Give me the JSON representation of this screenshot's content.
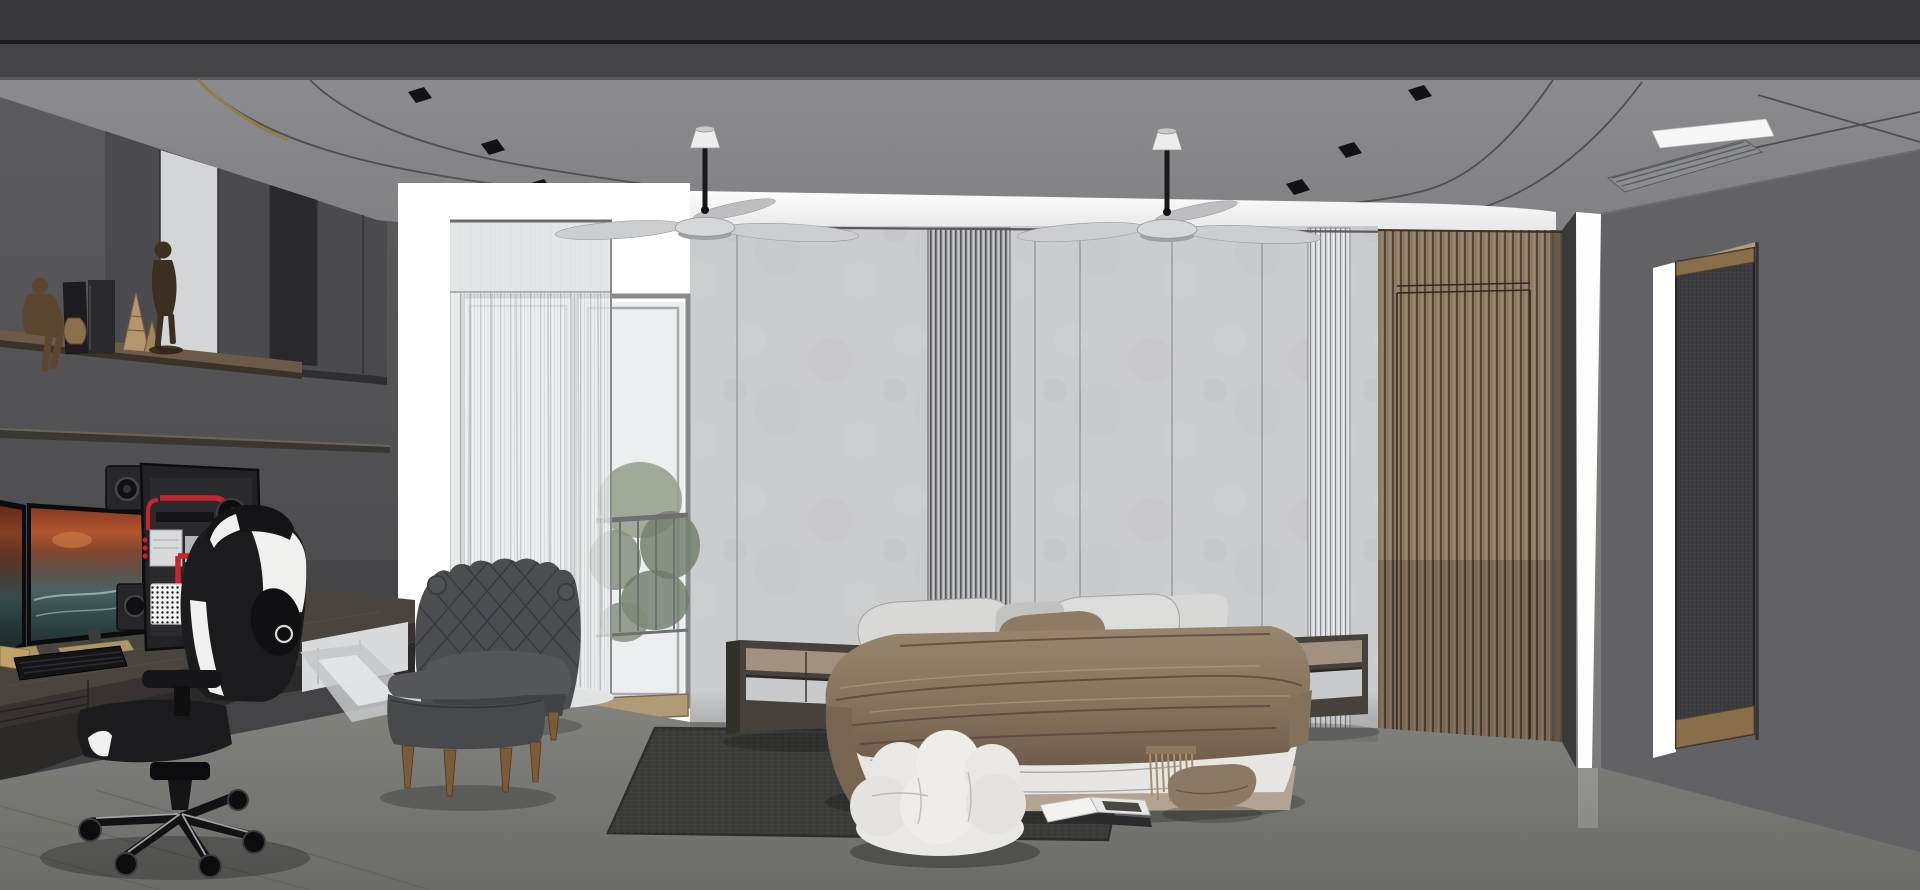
{
  "meta": {
    "title": "Modern bedroom interior — 3D architectural render (SketchUp style)",
    "view": "one-point perspective",
    "render_width": 1920,
    "render_height": 890
  },
  "palette": {
    "beam": "#38383a",
    "beamLine": "#1e1e20",
    "beam2": "#434346",
    "ceiling": "#87878b",
    "coveWhite": "#ffffff",
    "wallLight": "#cbccce",
    "wallSeam": "#8e8f92",
    "fluteDark": "#aeafb2",
    "fluteLight": "#d9dadc",
    "woodSlat": "#8e7a63",
    "woodSlatLine": "#51453a",
    "leftWall": "#56565a",
    "cabinet": "#4b4b4e",
    "cabinetDark": "#414144",
    "glassPanel": "#29292b",
    "concreteStrip": "#d4d5d7",
    "shelfWood": "#6a5a46",
    "shelfEdge": "#3b332a",
    "deskTop": "#4a443f",
    "deskFront": "#383330",
    "deskUnder": "#2c2a27",
    "floorA": "#82837e",
    "floorB": "#6d6e69",
    "floorSeam": "#5f605b",
    "rug": "#3b3b39",
    "rugWeave": "#47474a",
    "curtain": "#e9ebec",
    "frameGray": "#898a8c",
    "glassWhite": "#eceef0",
    "leafA": "#99a18f",
    "leafB": "#76806f",
    "thresholdWood": "#b09a78",
    "rightWall": "#626266",
    "jambWhite": "#ffffff",
    "mesh": "#3b3b3d",
    "trimWood": "#8a6d4a",
    "headerTan": "#b29a7c",
    "blanketA": "#9a846c",
    "blanketB": "#705e4b",
    "duvet": "#e7e6e2",
    "pillowLight": "#d8d8d6",
    "pillowGray": "#c2c2c0",
    "pillowBrown": "#8f7b63",
    "bedBase": "#b2a392",
    "nightFrame": "#46413b",
    "nightDrawer": "#a29180",
    "nightShelf": "#c9cacc",
    "chairDark": "#4b4d50",
    "chairSeat": "#54565a",
    "legWood": "#7c5b39",
    "gcBlack": "#1b1b1d",
    "gcWhite": "#f0f0ef",
    "pcRed": "#c6262c",
    "psuWhite": "#f2f2f3",
    "fanBlade": "#cdced0",
    "screenSky": "#b0542c",
    "screenSea": "#324a4b"
  },
  "scene": {
    "ceiling": {
      "finish": "matte gray slab with dark soffit beam across the top",
      "tray": "rounded-corner recessed tray with continuous white perimeter cove light and thin bronze trim at the left corner",
      "downlight_count": 6,
      "fan_count": 2,
      "fan_style": "3-blade modern silver fan on black downrod with white canopy",
      "ac_vent": "recessed cassette grille with bright edge, ceiling right"
    },
    "back_wall": {
      "material": "large light-gray concrete-look panels with vertical shadow seams",
      "fluted_strips": 2,
      "cove": "white light band running along the top, turning down into a vertical light slot at the right corner"
    },
    "wood_slat_wall": {
      "material": "vertical tan wood slats",
      "hidden_door": "flush concealed door outlined within the slats"
    },
    "window_zone": {
      "type": "glazed balcony French door, blown-out white daylight",
      "curtain": "floor-length white sheer with dense header band",
      "outside": "balcony railing and desaturated greenery visible through right pane",
      "threshold": "light wood sill"
    },
    "right_zone": {
      "doorway": "tall side opening with dark woven mesh screen panel, wood trims top and bottom, bright white lit jamb",
      "wall": "plain dark gray"
    },
    "desk_zone": {
      "upper_cabinets": "dark gray flat-front wall cabinets with one black glass door and a lit concrete strip",
      "shelves": [
        "decor display shelf",
        "thin empty shelf"
      ],
      "decor": [
        "seated wooden mannequin",
        "standing wooden mannequin",
        "2 upright books",
        "2 striped cone objects",
        "small patterned vase"
      ],
      "monitors": 2,
      "monitor_wallpaper": "orange sunset sky over dark stormy sea",
      "speakers": 2,
      "pc": "wall-mounted open-frame PC, red coolant tubing loop, 3 side fans, white honeycomb PSU",
      "keyboard": "dark low-profile keyboard",
      "chair": "black-and-white racing style gaming chair, 5-star base with casters"
    },
    "bed_zone": {
      "bed": "low platform bed, white duvet with taupe-brown rumpled throw and fringed blanket",
      "pillow_count": 5,
      "pillows": [
        "2 large light-gray",
        "1 small gray",
        "1 small white",
        "1 taupe front accent"
      ],
      "nightstands": "2 floating box nightstands, taupe drawer band over open lit shelf",
      "pouf": "white puffy cloud pouf at foot of bed",
      "floor_cushion": "taupe floor cushion, right of bed",
      "magazine": "open magazine lying on floor at bed foot",
      "rug": "large dark charcoal woven area rug"
    },
    "lounge_zone": {
      "armchair": "dark gray diamond-tufted scroll-back slipper chair, wood legs",
      "ottoman": "matching rectangular ottoman, wood legs"
    },
    "floor": "gray micro-cement floor with faint diagonal joints and a bright light pool near the balcony door"
  },
  "objects": [
    {
      "name": "ceiling-beam"
    },
    {
      "name": "ceiling"
    },
    {
      "name": "cove-light-band"
    },
    {
      "name": "downlights",
      "count": 6
    },
    {
      "name": "ceiling-fan",
      "count": 2
    },
    {
      "name": "ac-vent"
    },
    {
      "name": "back-wall-panels"
    },
    {
      "name": "fluted-panel",
      "count": 2
    },
    {
      "name": "wood-slat-door"
    },
    {
      "name": "corner-light-slot"
    },
    {
      "name": "mesh-screen-doorway"
    },
    {
      "name": "balcony-door"
    },
    {
      "name": "sheer-curtain"
    },
    {
      "name": "upper-cabinets"
    },
    {
      "name": "decor-shelf"
    },
    {
      "name": "wall-shelf"
    },
    {
      "name": "dual-monitors"
    },
    {
      "name": "open-frame-pc"
    },
    {
      "name": "speakers",
      "count": 2
    },
    {
      "name": "keyboard"
    },
    {
      "name": "gaming-desk"
    },
    {
      "name": "gaming-chair"
    },
    {
      "name": "bed"
    },
    {
      "name": "nightstand",
      "count": 2
    },
    {
      "name": "cloud-pouf"
    },
    {
      "name": "floor-cushion"
    },
    {
      "name": "open-magazine"
    },
    {
      "name": "area-rug"
    },
    {
      "name": "tufted-armchair"
    },
    {
      "name": "ottoman"
    }
  ]
}
